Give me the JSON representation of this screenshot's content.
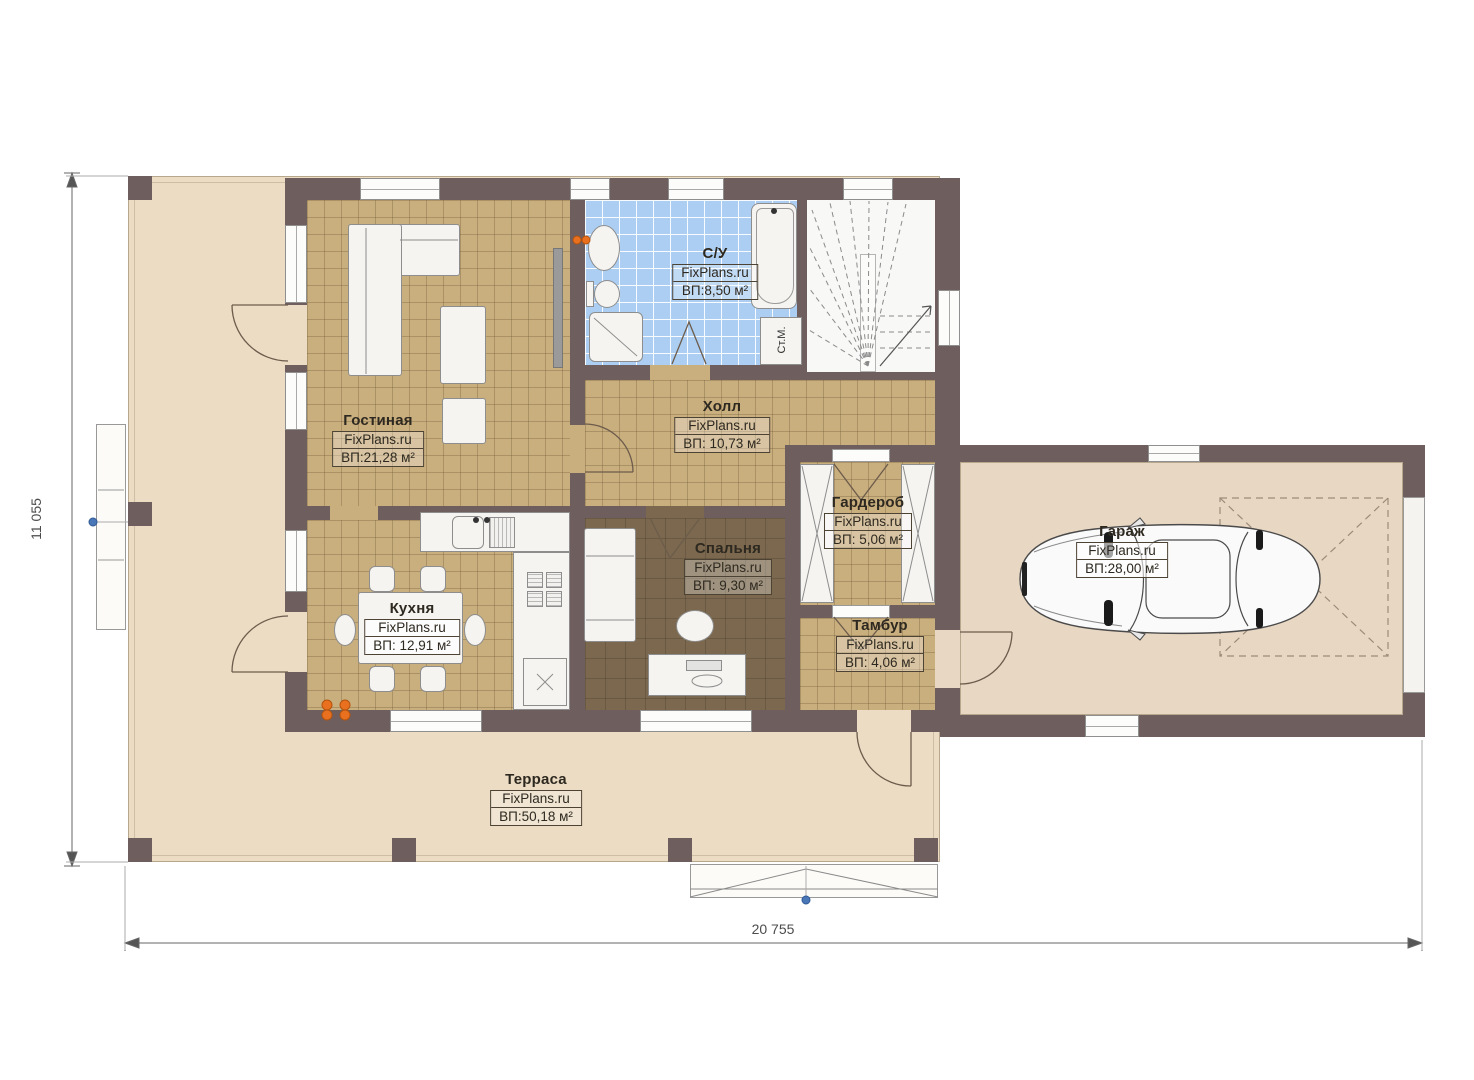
{
  "brand": "FixPlans.ru",
  "rooms": {
    "living": {
      "name": "Гостиная",
      "area": "ВП:21,28 м²"
    },
    "bathroom": {
      "name": "С/У",
      "area": "ВП:8,50 м²"
    },
    "hall": {
      "name": "Холл",
      "area": "ВП: 10,73 м²"
    },
    "kitchen": {
      "name": "Кухня",
      "area": "ВП: 12,91 м²"
    },
    "bedroom": {
      "name": "Спальня",
      "area": "ВП: 9,30 м²"
    },
    "wardrobe": {
      "name": "Гардероб",
      "area": "ВП: 5,06 м²"
    },
    "vestibule": {
      "name": "Тамбур",
      "area": "ВП: 4,06 м²"
    },
    "garage": {
      "name": "Гараж",
      "area": "ВП:28,00 м²"
    },
    "terrace": {
      "name": "Терраса",
      "area": "ВП:50,18 м²"
    }
  },
  "appliances": {
    "washing_machine": "Ст.М."
  },
  "dimensions": {
    "overall_width": "20 755",
    "overall_height": "11 055"
  },
  "colors": {
    "wall": "#6f5e5e",
    "tile_floor": "#c9ae7e",
    "bedroom_floor": "#7b684e",
    "bathroom_tile": "#abcef2",
    "terrace_floor": "#ebdcc3",
    "garage_floor": "#e8d7c3",
    "radiator": "#e9701e",
    "marker_blue": "#4a77b8"
  }
}
